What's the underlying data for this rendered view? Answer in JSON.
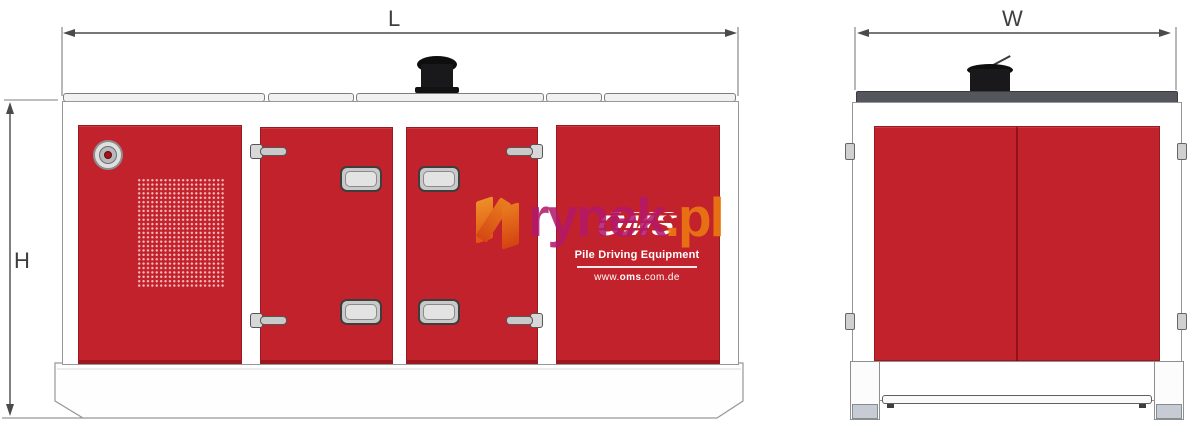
{
  "dimensions": {
    "length_label": "L",
    "height_label": "H",
    "width_label": "W"
  },
  "branding": {
    "logo_text": "OMS",
    "tagline": "Pile Driving Equipment",
    "website_prefix": "www.",
    "website_bold": "oms",
    "website_suffix": ".com.de"
  },
  "watermark": {
    "text_main": "rynek",
    "text_suffix": ".pl"
  },
  "colors": {
    "panel_red": "#c2222b",
    "panel_red_edge": "#991b21",
    "roof_gray": "#55555c",
    "cap_black": "#121212",
    "outline_gray": "#979797",
    "dimension_line": "#4a4a4a",
    "watermark_magenta": "#b2186a",
    "watermark_orange": "#ee7d12"
  },
  "icons": {
    "exhaust_cap": "css-cylinder-shape",
    "vent_grille": "css-dot-grid",
    "lifting_port": "css-concentric-circles",
    "door_hinge": "css-knuckle-paddle-shape",
    "door_handle": "css-rounded-rect",
    "watermark_logo": "css-orange-parallelograms"
  }
}
